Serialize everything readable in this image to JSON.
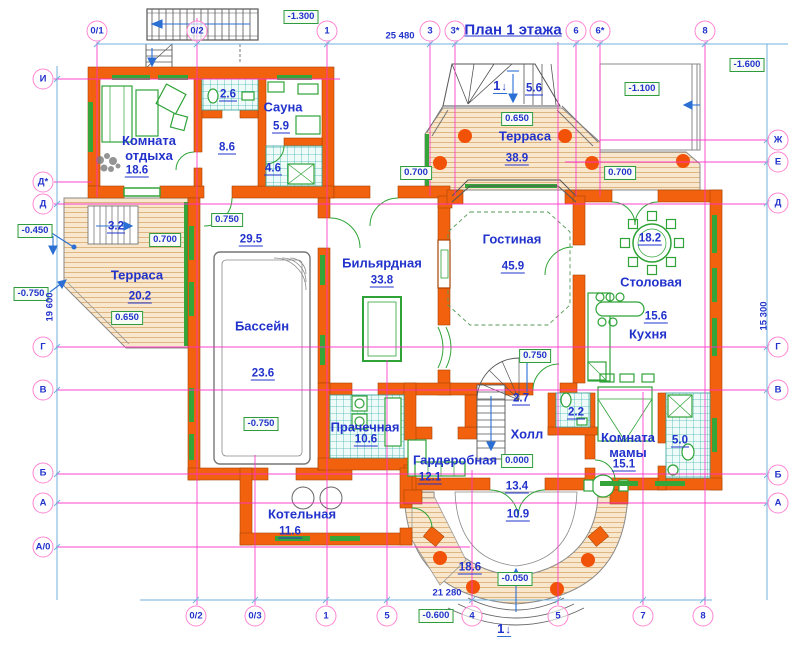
{
  "title": "План 1 этажа",
  "colors": {
    "wall_orange": "#f2610e",
    "grid_magenta": "#ff2fc8",
    "label_blue": "#2233cc",
    "elevation_green": "#2e9b3e",
    "dimension_blue": "#6fb0dd",
    "furniture_green": "#2fa338",
    "terrace_wood": "#f8e7cc",
    "tile_teal": "#45b5b0"
  },
  "rooms": [
    {
      "name": "Комната отдыха",
      "lines": [
        "Комната",
        "отдыха"
      ],
      "nx": 149,
      "ny": 148,
      "area": "18.6",
      "ax": 137,
      "ay": 171
    },
    {
      "name": "Сауна",
      "lines": [
        "Сауна"
      ],
      "nx": 283,
      "ny": 107,
      "area": "5.9",
      "ax": 281,
      "ay": 127
    },
    {
      "name": "Терраса",
      "lines": [
        "Терраса"
      ],
      "nx": 525,
      "ny": 136,
      "area": "38.9",
      "ax": 517,
      "ay": 159
    },
    {
      "name": "Терраса",
      "lines": [
        "Терраса"
      ],
      "nx": 137,
      "ny": 275,
      "area": "20.2",
      "ax": 140,
      "ay": 297
    },
    {
      "name": "Бильярдная",
      "lines": [
        "Бильярдная"
      ],
      "nx": 382,
      "ny": 263,
      "area": "33.8",
      "ax": 382,
      "ay": 281
    },
    {
      "name": "Гостиная",
      "lines": [
        "Гостиная"
      ],
      "nx": 512,
      "ny": 239,
      "area": "45.9",
      "ax": 513,
      "ay": 267
    },
    {
      "name": "Столовая",
      "lines": [
        "Столовая"
      ],
      "nx": 651,
      "ny": 282,
      "area": "18.2",
      "ax": 650,
      "ay": 239
    },
    {
      "name": "Кухня",
      "lines": [
        "Кухня"
      ],
      "nx": 648,
      "ny": 334,
      "area": "15.6",
      "ax": 656,
      "ay": 317
    },
    {
      "name": "Бассейн",
      "lines": [
        "Бассейн"
      ],
      "nx": 262,
      "ny": 326,
      "area": "23.6",
      "ax": 263,
      "ay": 374
    },
    {
      "name": "Прачечная",
      "lines": [
        "Прачечная"
      ],
      "nx": 365,
      "ny": 427,
      "area": "10.6",
      "ax": 366,
      "ay": 440
    },
    {
      "name": "Гардеробная",
      "lines": [
        "Гардеробная"
      ],
      "nx": 455,
      "ny": 460,
      "area": "12.1",
      "ax": 430,
      "ay": 478
    },
    {
      "name": "Холл",
      "lines": [
        "Холл"
      ],
      "nx": 527,
      "ny": 434,
      "area": "13.4",
      "ax": 517,
      "ay": 487
    },
    {
      "name": "Комната мамы",
      "lines": [
        "Комната",
        "мамы"
      ],
      "nx": 628,
      "ny": 445,
      "area": "15.1",
      "ax": 624,
      "ay": 465
    },
    {
      "name": "Котельная",
      "lines": [
        "Котельная"
      ],
      "nx": 302,
      "ny": 514,
      "area": "11.6",
      "ax": 290,
      "ay": 532
    }
  ],
  "small_areas": [
    {
      "value": "2.6",
      "x": 228,
      "y": 95
    },
    {
      "value": "8.6",
      "x": 227,
      "y": 148
    },
    {
      "value": "4.6",
      "x": 273,
      "y": 169
    },
    {
      "value": "3.2",
      "x": 116,
      "y": 227
    },
    {
      "value": "5.6",
      "x": 534,
      "y": 89
    },
    {
      "value": "29.5",
      "x": 251,
      "y": 240
    },
    {
      "value": "2.7",
      "x": 521,
      "y": 399
    },
    {
      "value": "2.2",
      "x": 576,
      "y": 413
    },
    {
      "value": "5.0",
      "x": 680,
      "y": 441
    },
    {
      "value": "10.9",
      "x": 518,
      "y": 515
    },
    {
      "value": "18.6",
      "x": 470,
      "y": 568
    }
  ],
  "elevation_marks": [
    {
      "value": "-1.300",
      "x": 301,
      "y": 17
    },
    {
      "value": "-1.600",
      "x": 747,
      "y": 65
    },
    {
      "value": "-1.100",
      "x": 642,
      "y": 89
    },
    {
      "value": "0.650",
      "x": 517,
      "y": 119
    },
    {
      "value": "0.700",
      "x": 416,
      "y": 173
    },
    {
      "value": "0.700",
      "x": 620,
      "y": 173
    },
    {
      "value": "0.750",
      "x": 227,
      "y": 220
    },
    {
      "value": "0.700",
      "x": 165,
      "y": 240
    },
    {
      "value": "0.650",
      "x": 127,
      "y": 318
    },
    {
      "value": "-0.450",
      "x": 35,
      "y": 231
    },
    {
      "value": "-0.750",
      "x": 31,
      "y": 294
    },
    {
      "value": "-0.750",
      "x": 261,
      "y": 424
    },
    {
      "value": "0.750",
      "x": 535,
      "y": 356
    },
    {
      "value": "0.000",
      "x": 517,
      "y": 461
    },
    {
      "value": "-0.050",
      "x": 515,
      "y": 579
    },
    {
      "value": "-0.600",
      "x": 436,
      "y": 616
    }
  ],
  "axes": {
    "top": [
      {
        "label": "0/1",
        "x": 97
      },
      {
        "label": "0/2",
        "x": 197
      },
      {
        "label": "1",
        "x": 327
      },
      {
        "label": "3",
        "x": 430
      },
      {
        "label": "3*",
        "x": 455
      },
      {
        "label": "6",
        "x": 576
      },
      {
        "label": "6*",
        "x": 600
      },
      {
        "label": "8",
        "x": 705
      }
    ],
    "bottom": [
      {
        "label": "0/2",
        "x": 196
      },
      {
        "label": "0/3",
        "x": 255
      },
      {
        "label": "1",
        "x": 326
      },
      {
        "label": "5",
        "x": 387
      },
      {
        "label": "4",
        "x": 472
      },
      {
        "label": "5",
        "x": 558
      },
      {
        "label": "7",
        "x": 643
      },
      {
        "label": "8",
        "x": 703
      }
    ],
    "left": [
      {
        "label": "И",
        "y": 79
      },
      {
        "label": "Д*",
        "y": 182
      },
      {
        "label": "Д",
        "y": 204
      },
      {
        "label": "Г",
        "y": 347
      },
      {
        "label": "В",
        "y": 390
      },
      {
        "label": "Б",
        "y": 473
      },
      {
        "label": "А",
        "y": 503
      },
      {
        "label": "А/0",
        "y": 547
      }
    ],
    "right": [
      {
        "label": "Ж",
        "y": 140
      },
      {
        "label": "Е",
        "y": 162
      },
      {
        "label": "Д",
        "y": 203
      },
      {
        "label": "Г",
        "y": 347
      },
      {
        "label": "В",
        "y": 390
      },
      {
        "label": "Б",
        "y": 475
      },
      {
        "label": "А",
        "y": 503
      }
    ]
  },
  "dimensions": {
    "top": "25 480",
    "bottom": "21 280",
    "left": "19 600",
    "right": "15 300"
  },
  "section_marks": [
    {
      "label": "1",
      "x": 500,
      "y": 86
    },
    {
      "label": "1",
      "x": 504,
      "y": 629
    }
  ]
}
